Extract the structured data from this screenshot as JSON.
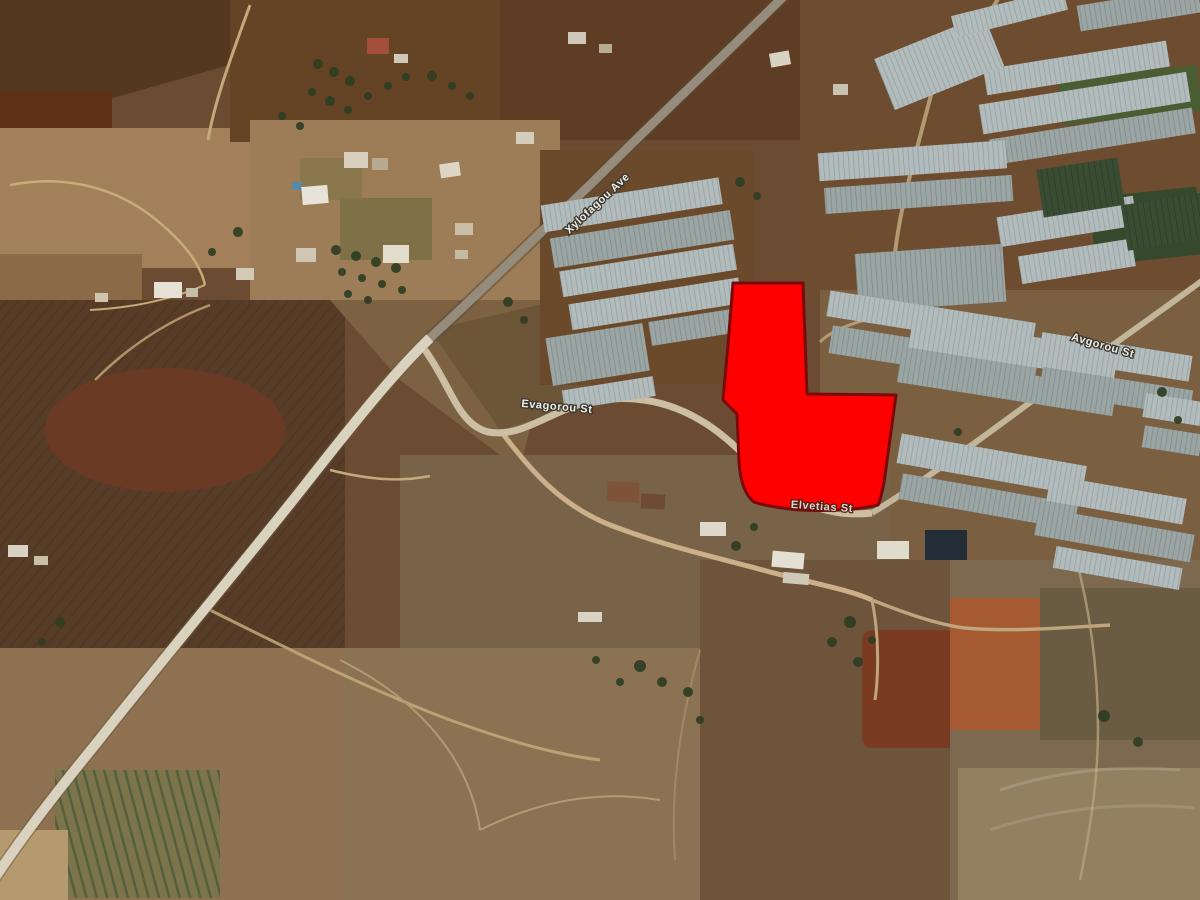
{
  "app": {
    "name": "satellite-map-view"
  },
  "map": {
    "kind": "satellite-imagery-with-parcel-overlay",
    "highlight_parcel": {
      "label": "highlighted land parcel",
      "fill": "#FE0000",
      "outline": "#7A0A0A"
    },
    "street_labels": [
      {
        "id": "diagonal-avenue",
        "label": "Xylofagou Ave"
      },
      {
        "id": "west-street",
        "label": "Evagorou St"
      },
      {
        "id": "parcel-street",
        "label": "Elvetias St"
      },
      {
        "id": "northeast-street",
        "label": "Avgorou St"
      }
    ],
    "palette": {
      "terrain_base": "#6B4C33",
      "field_dark": "#573D28",
      "field_tan": "#A3805A",
      "road_light": "#D9D2BF",
      "road_gray": "#958C7C",
      "greenhouse": "#B3BCBC",
      "crop_green": "#55603A",
      "pond_dark": "#232D38"
    }
  }
}
